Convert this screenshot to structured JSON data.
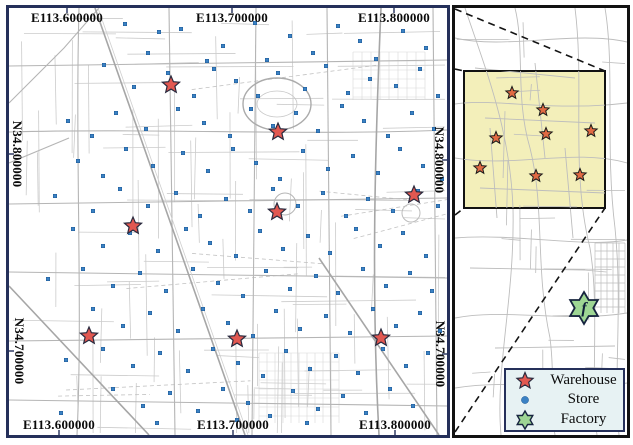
{
  "main_map": {
    "axis_labels": {
      "top": [
        {
          "text": "E113.600000",
          "x": 58
        },
        {
          "text": "E113.700000",
          "x": 223
        },
        {
          "text": "E113.800000",
          "x": 385
        }
      ],
      "bottom": [
        {
          "text": "E113.600000",
          "x": 50
        },
        {
          "text": "E113.700000",
          "x": 224
        },
        {
          "text": "E113.800000",
          "x": 386
        }
      ],
      "left": [
        {
          "text": "N34.800000",
          "y": 146
        },
        {
          "text": "N34.700000",
          "y": 343
        }
      ],
      "right": [
        {
          "text": "N34.800000",
          "y": 152
        },
        {
          "text": "N34.700000",
          "y": 346
        }
      ]
    },
    "warehouses": [
      [
        162,
        77
      ],
      [
        269,
        124
      ],
      [
        405,
        187
      ],
      [
        268,
        204
      ],
      [
        124,
        218
      ],
      [
        80,
        328
      ],
      [
        228,
        331
      ],
      [
        372,
        330
      ]
    ],
    "stores": [
      [
        116,
        16
      ],
      [
        150,
        24
      ],
      [
        172,
        21
      ],
      [
        214,
        38
      ],
      [
        246,
        15
      ],
      [
        281,
        28
      ],
      [
        304,
        45
      ],
      [
        329,
        18
      ],
      [
        351,
        33
      ],
      [
        367,
        51
      ],
      [
        394,
        23
      ],
      [
        417,
        40
      ],
      [
        198,
        53
      ],
      [
        139,
        45
      ],
      [
        258,
        52
      ],
      [
        95,
        57
      ],
      [
        125,
        79
      ],
      [
        159,
        65
      ],
      [
        185,
        88
      ],
      [
        205,
        61
      ],
      [
        227,
        73
      ],
      [
        249,
        88
      ],
      [
        269,
        65
      ],
      [
        296,
        81
      ],
      [
        317,
        58
      ],
      [
        339,
        85
      ],
      [
        361,
        71
      ],
      [
        387,
        78
      ],
      [
        411,
        61
      ],
      [
        429,
        88
      ],
      [
        107,
        105
      ],
      [
        137,
        121
      ],
      [
        169,
        101
      ],
      [
        195,
        115
      ],
      [
        221,
        128
      ],
      [
        242,
        101
      ],
      [
        264,
        118
      ],
      [
        287,
        105
      ],
      [
        309,
        123
      ],
      [
        333,
        98
      ],
      [
        355,
        113
      ],
      [
        379,
        128
      ],
      [
        403,
        105
      ],
      [
        425,
        121
      ],
      [
        59,
        113
      ],
      [
        83,
        128
      ],
      [
        117,
        141
      ],
      [
        144,
        158
      ],
      [
        174,
        145
      ],
      [
        199,
        163
      ],
      [
        224,
        141
      ],
      [
        247,
        155
      ],
      [
        271,
        171
      ],
      [
        294,
        143
      ],
      [
        319,
        161
      ],
      [
        344,
        148
      ],
      [
        369,
        165
      ],
      [
        391,
        141
      ],
      [
        414,
        158
      ],
      [
        433,
        171
      ],
      [
        69,
        153
      ],
      [
        94,
        168
      ],
      [
        46,
        188
      ],
      [
        84,
        203
      ],
      [
        111,
        181
      ],
      [
        139,
        198
      ],
      [
        167,
        185
      ],
      [
        191,
        208
      ],
      [
        217,
        191
      ],
      [
        241,
        203
      ],
      [
        264,
        181
      ],
      [
        289,
        198
      ],
      [
        314,
        185
      ],
      [
        337,
        208
      ],
      [
        359,
        191
      ],
      [
        384,
        203
      ],
      [
        409,
        183
      ],
      [
        429,
        198
      ],
      [
        64,
        221
      ],
      [
        94,
        238
      ],
      [
        121,
        225
      ],
      [
        149,
        243
      ],
      [
        177,
        221
      ],
      [
        201,
        235
      ],
      [
        227,
        248
      ],
      [
        251,
        223
      ],
      [
        274,
        241
      ],
      [
        299,
        228
      ],
      [
        321,
        245
      ],
      [
        347,
        221
      ],
      [
        371,
        238
      ],
      [
        394,
        225
      ],
      [
        417,
        248
      ],
      [
        74,
        261
      ],
      [
        104,
        278
      ],
      [
        131,
        265
      ],
      [
        157,
        283
      ],
      [
        184,
        261
      ],
      [
        209,
        275
      ],
      [
        234,
        288
      ],
      [
        257,
        263
      ],
      [
        281,
        281
      ],
      [
        307,
        268
      ],
      [
        329,
        285
      ],
      [
        354,
        261
      ],
      [
        377,
        278
      ],
      [
        401,
        265
      ],
      [
        423,
        283
      ],
      [
        39,
        271
      ],
      [
        84,
        301
      ],
      [
        114,
        318
      ],
      [
        141,
        305
      ],
      [
        169,
        323
      ],
      [
        194,
        301
      ],
      [
        219,
        315
      ],
      [
        244,
        328
      ],
      [
        267,
        303
      ],
      [
        291,
        321
      ],
      [
        317,
        308
      ],
      [
        341,
        325
      ],
      [
        364,
        301
      ],
      [
        387,
        318
      ],
      [
        411,
        305
      ],
      [
        431,
        323
      ],
      [
        94,
        341
      ],
      [
        124,
        358
      ],
      [
        151,
        345
      ],
      [
        179,
        363
      ],
      [
        204,
        341
      ],
      [
        229,
        355
      ],
      [
        254,
        368
      ],
      [
        277,
        343
      ],
      [
        301,
        361
      ],
      [
        327,
        348
      ],
      [
        349,
        365
      ],
      [
        374,
        341
      ],
      [
        397,
        358
      ],
      [
        419,
        345
      ],
      [
        57,
        352
      ],
      [
        104,
        381
      ],
      [
        134,
        398
      ],
      [
        161,
        385
      ],
      [
        189,
        403
      ],
      [
        214,
        381
      ],
      [
        239,
        395
      ],
      [
        261,
        408
      ],
      [
        284,
        383
      ],
      [
        309,
        401
      ],
      [
        334,
        388
      ],
      [
        357,
        405
      ],
      [
        381,
        381
      ],
      [
        404,
        398
      ],
      [
        148,
        415
      ],
      [
        228,
        412
      ],
      [
        298,
        415
      ],
      [
        52,
        405
      ]
    ]
  },
  "inset": {
    "highlight_region": {
      "x": 9,
      "y": 63,
      "w": 141,
      "h": 137
    },
    "warehouses": [
      [
        57,
        85
      ],
      [
        88,
        102
      ],
      [
        136,
        123
      ],
      [
        91,
        126
      ],
      [
        41,
        130
      ],
      [
        25,
        160
      ],
      [
        81,
        168
      ],
      [
        125,
        167
      ]
    ],
    "factory": {
      "x": 129,
      "y": 300,
      "label": "f"
    },
    "connector_lines": [
      [
        0,
        1,
        150,
        63
      ],
      [
        0,
        424,
        150,
        200
      ],
      [
        0,
        61,
        9,
        63
      ],
      [
        0,
        207,
        9,
        200
      ]
    ]
  },
  "legend": {
    "items": [
      {
        "marker": "warehouse-star",
        "label": "Warehouse"
      },
      {
        "marker": "store-dot",
        "label": "Store"
      },
      {
        "marker": "factory-star",
        "label": "Factory"
      }
    ]
  },
  "colors": {
    "map_border": "#25305a",
    "inset_border": "#121212",
    "warehouse_fill": "#e25851",
    "warehouse_stroke": "#2a2a3e",
    "store_fill": "#3b82c4",
    "store_stroke": "#1f5a96",
    "inset_star_fill": "#e06a43",
    "inset_star_stroke": "#1a1a1a",
    "factory_fill": "#9ed694",
    "factory_stroke": "#17253f",
    "highlight_fill": "#f3efba",
    "legend_bg": "#e7f2f3",
    "street_minor": "#c9c9c9",
    "street_major": "#a6a6a6"
  }
}
